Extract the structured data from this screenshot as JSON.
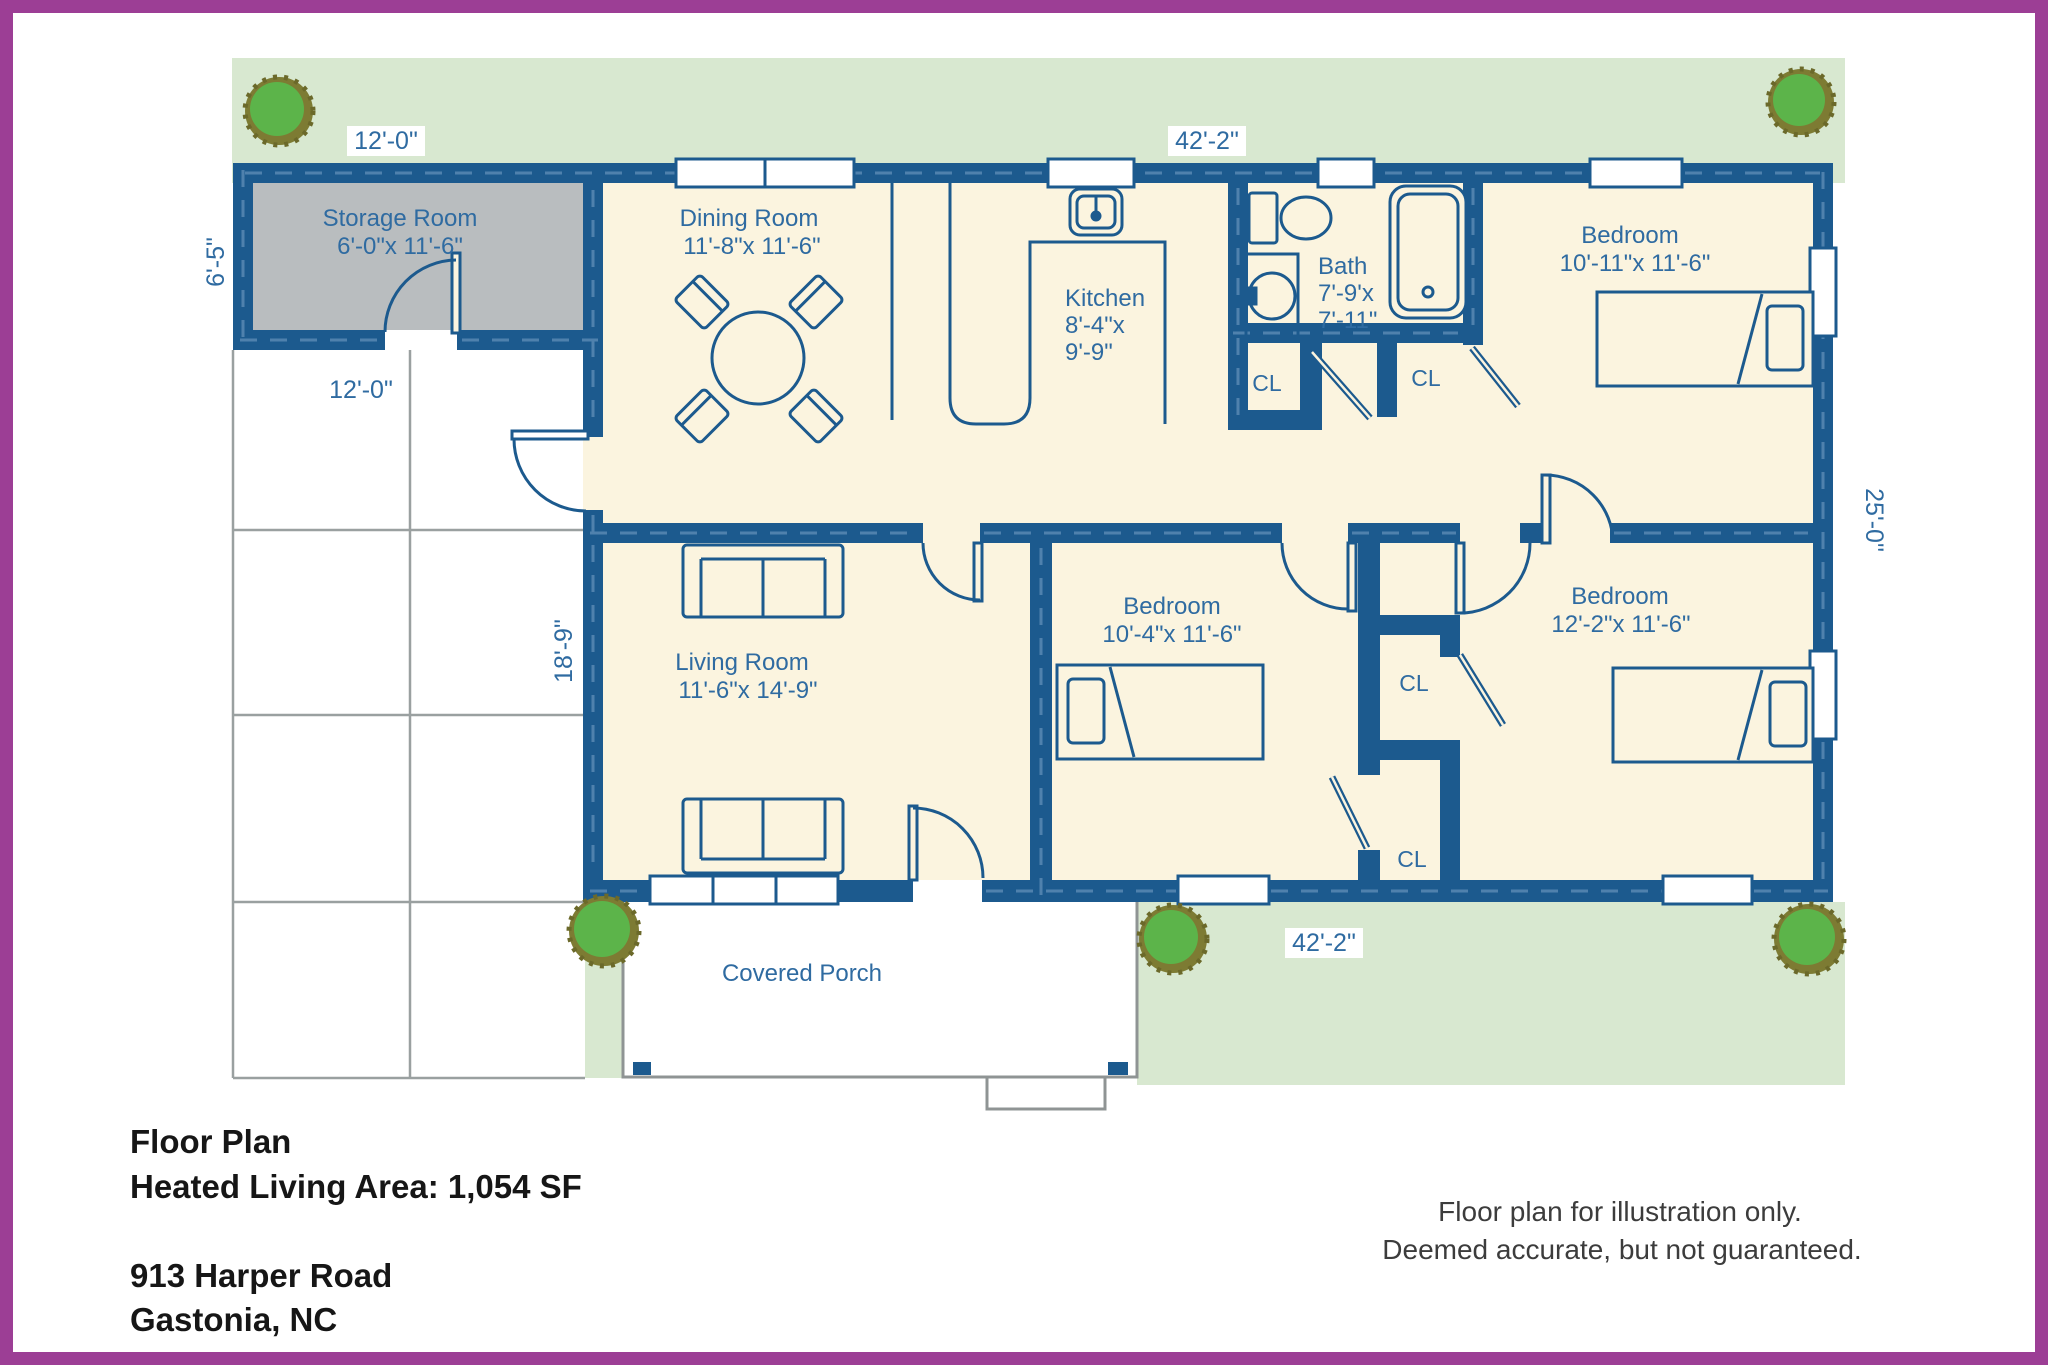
{
  "colors": {
    "frame_purple": "#9c3e95",
    "wall_blue": "#1c5a8e",
    "wall_dash_blue": "#4f81ad",
    "floor_cream": "#fbf4df",
    "storage_gray": "#b9bdbf",
    "grass_green": "#d8e8d0",
    "tree_green": "#5cb44a",
    "tree_ring_olive": "#7d7b33",
    "label_blue": "#2f6ba1",
    "grid_gray": "#9aa0a0",
    "porch_gray": "#8f9494",
    "footer_text_black": "#161616"
  },
  "plan": {
    "labels": {
      "storage_name": "Storage Room",
      "storage_dims": "6'-0\"x 11'-6\"",
      "dining_name": "Dining Room",
      "dining_dims": "11'-8\"x 11'-6\"",
      "kitchen_name": "Kitchen",
      "kitchen_dims1": "8'-4\"x",
      "kitchen_dims2": "9'-9\"",
      "bath_name": "Bath",
      "bath_dims1": "7'-9'x",
      "bath_dims2": "7'-11\"",
      "bedroom_top_right_name": "Bedroom",
      "bedroom_top_right_dims": "10'-11\"x 11'-6\"",
      "bedroom_middle_name": "Bedroom",
      "bedroom_middle_dims": "10'-4\"x 11'-6\"",
      "bedroom_bottom_right_name": "Bedroom",
      "bedroom_bottom_right_dims": "12'-2\"x 11'-6\"",
      "living_name": "Living Room",
      "living_dims": "11'-6\"x 14'-9\"",
      "porch_name": "Covered Porch",
      "closet": "CL"
    },
    "dimensions": {
      "storage_width": "12'-0\"",
      "house_width_top": "42'-2\"",
      "storage_height": "6'-5\"",
      "carport_width": "12'-0\"",
      "carport_height": "18'-9\"",
      "house_depth": "25'-0\"",
      "house_width_bottom": "42'-2\""
    }
  },
  "footer": {
    "title": "Floor Plan",
    "area": "Heated Living Area: 1,054 SF",
    "address_line1": "913 Harper Road",
    "address_line2": "Gastonia, NC",
    "disclaimer_line1": "Floor plan for illustration only.",
    "disclaimer_line2": "Deemed accurate, but not guaranteed."
  }
}
